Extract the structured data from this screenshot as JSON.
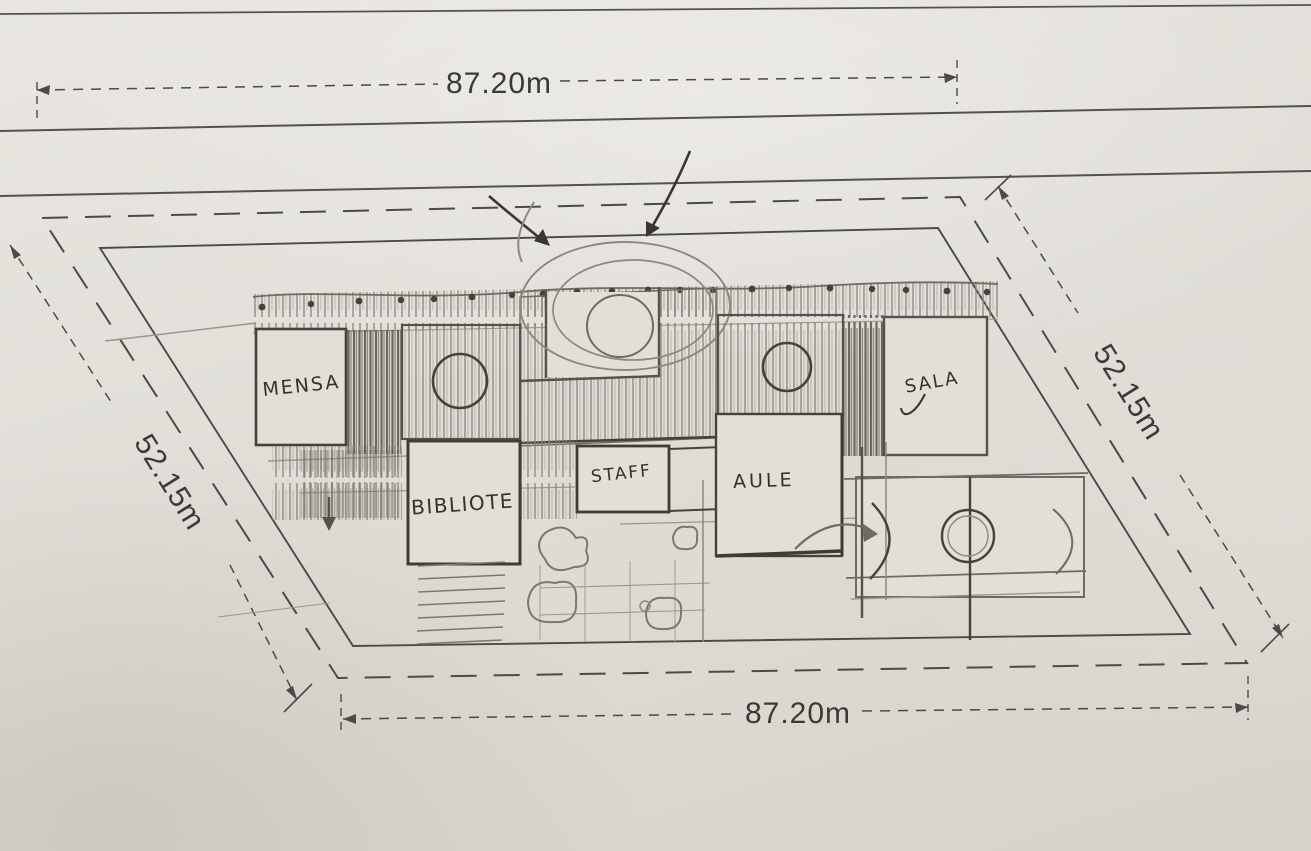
{
  "plan": {
    "title": "hand-drawn school site plan sketch",
    "dimensions": {
      "top": "87.20m",
      "bottom": "87.20m",
      "left": "52.15m",
      "right": "52.15m"
    },
    "rooms": {
      "mensa": "MENSA",
      "biblioteca": "BIBLIOTE",
      "staff": "STAFF",
      "aule": "AULE",
      "sala": "SALA"
    },
    "colors": {
      "paper": "#e2dfd9",
      "print_ink": "#4c4a46",
      "sketch_ink": "#3f3c37",
      "pencil": "#8d8780"
    }
  }
}
